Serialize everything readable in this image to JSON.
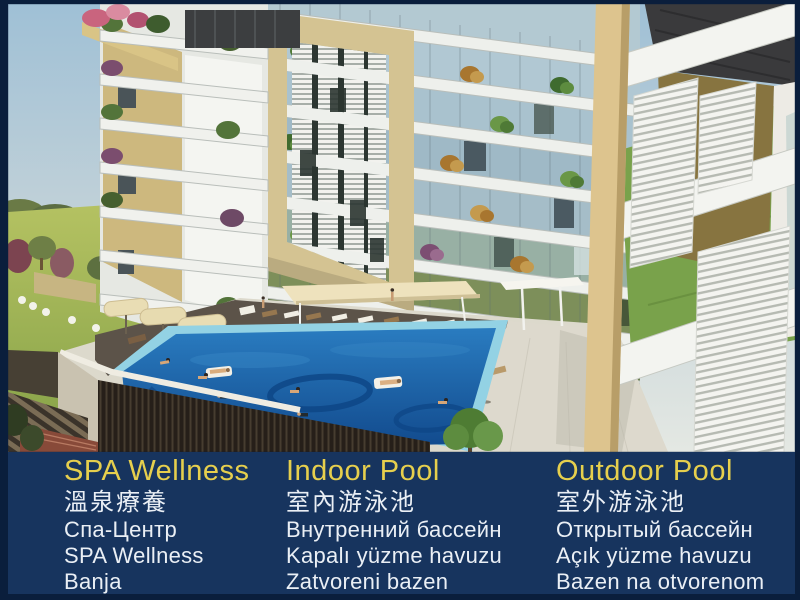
{
  "window": {
    "width_px": 800,
    "height_px": 600
  },
  "colors": {
    "border": "#0a1e3c",
    "band_background": "#17345e",
    "title_yellow": "#e6cf4d",
    "body_text": "#eaeff5",
    "pool_water": "#1d66ab",
    "facade_tan": "#d4c392",
    "lawn_green": "#a9bb58"
  },
  "caption_bar": {
    "columns": [
      {
        "id": "spa-wellness",
        "title": "SPA Wellness",
        "lines": [
          "溫泉療養",
          "Спа-Центр",
          "SPA Wellness",
          "Banja"
        ]
      },
      {
        "id": "indoor-pool",
        "title": "Indoor Pool",
        "lines": [
          "室內游泳池",
          "Внутренний бассейн",
          "Kapalı yüzme havuzu",
          "Zatvoreni bazen"
        ]
      },
      {
        "id": "outdoor-pool",
        "title": "Outdoor Pool",
        "lines": [
          "室外游泳池",
          "Открытый бассейн",
          "Açık yüzme havuzu",
          "Bazen na otvorenom"
        ]
      }
    ]
  }
}
